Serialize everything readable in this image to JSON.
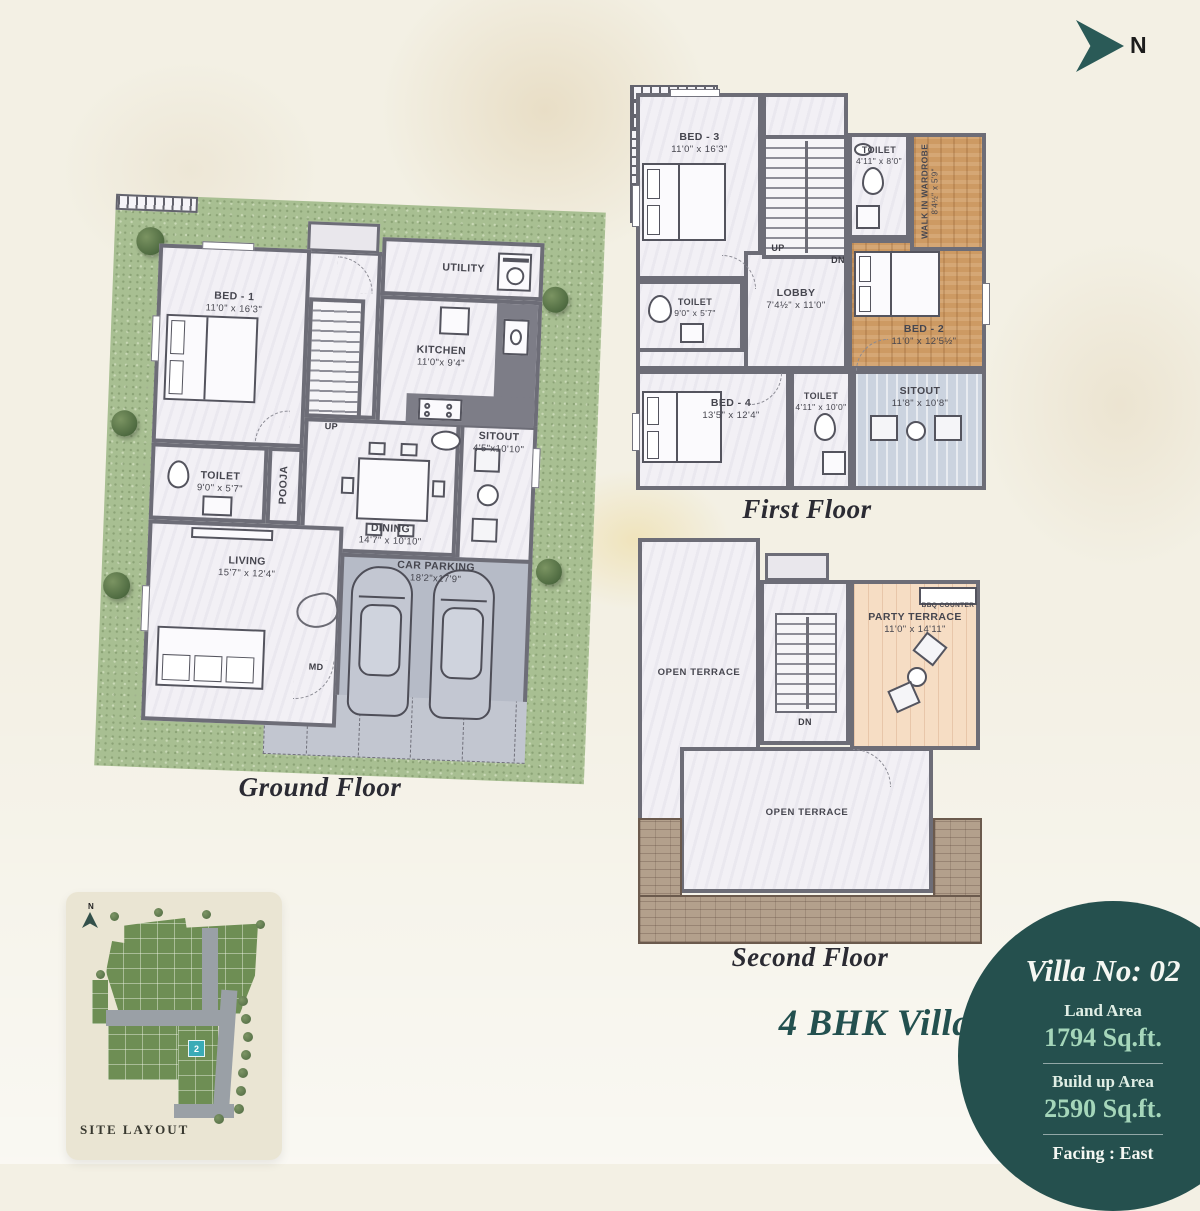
{
  "page": {
    "villa_type": "4 BHK Villa"
  },
  "north": {
    "label": "N",
    "icon": "north-arrow-icon"
  },
  "ground_floor": {
    "caption": "Ground Floor",
    "bed1_name": "BED - 1",
    "bed1_dim": "11'0\" x 16'3\"",
    "utility": "UTILITY",
    "kitchen_name": "KITCHEN",
    "kitchen_dim": "11'0\"x 9'4\"",
    "toilet_name": "TOILET",
    "toilet_dim": "9'0\" x 5'7\"",
    "pooja": "POOJA",
    "dining_name": "DINING",
    "dining_dim": "14'7\" x 10'10\"",
    "sitout_name": "SITOUT",
    "sitout_dim": "4'5\"x10'10\"",
    "living_name": "LIVING",
    "living_dim": "15'7\" x 12'4\"",
    "parking_name": "CAR PARKING",
    "parking_dim": "18'2\"x17'9\"",
    "up": "UP",
    "md": "MD"
  },
  "first_floor": {
    "caption": "First Floor",
    "bed3_name": "BED - 3",
    "bed3_dim": "11'0\" x 16'3\"",
    "toilet1_name": "TOILET",
    "toilet1_dim": "4'11\" x 8'0\"",
    "wardrobe_name": "WALK IN WARDROBE",
    "wardrobe_dim": "8'4½\" x 5'9\"",
    "lobby_name": "LOBBY",
    "lobby_dim": "7'4½\" x 11'0\"",
    "toilet2_name": "TOILET",
    "toilet2_dim": "9'0\" x 5'7\"",
    "bed2_name": "BED - 2",
    "bed2_dim": "11'0\" x 12'5½\"",
    "bed4_name": "BED - 4",
    "bed4_dim": "13'5\" x 12'4\"",
    "toilet3_name": "TOILET",
    "toilet3_dim": "4'11\" x 10'0\"",
    "sitout_name": "SITOUT",
    "sitout_dim": "11'8\" x 10'8\"",
    "up": "UP",
    "dn": "DN"
  },
  "second_floor": {
    "caption": "Second Floor",
    "open_terrace_left": "OPEN TERRACE",
    "open_terrace_bottom": "OPEN TERRACE",
    "party_name": "PARTY TERRACE",
    "party_dim": "11'0\" x 14'11\"",
    "bbq": "BBQ COUNTER",
    "dn": "DN"
  },
  "site_layout": {
    "caption": "SITE LAYOUT",
    "plot": "2",
    "north": "N"
  },
  "villa_info": {
    "title": "Villa No: 02",
    "land_label": "Land Area",
    "land_value": "1794 Sq.ft.",
    "build_label": "Build up Area",
    "build_value": "2590 Sq.ft.",
    "facing": "Facing : East"
  },
  "colors": {
    "teal": "#25504e",
    "mint": "#a5d6ba",
    "lawn_green": "#a8bf92",
    "wood": "#cd9a63",
    "plot_marker": "#3aabb6",
    "wall": "#6d6d77"
  }
}
